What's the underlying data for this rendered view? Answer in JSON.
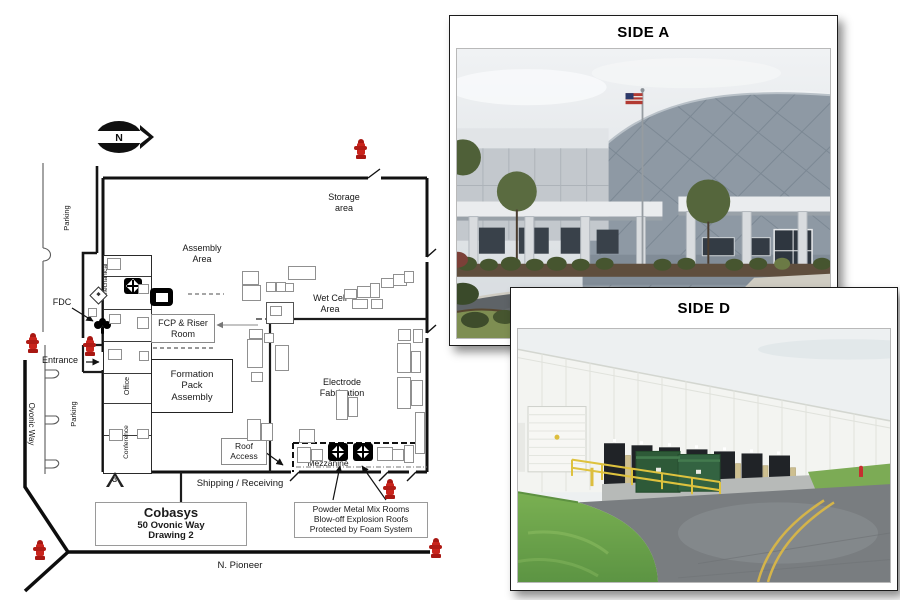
{
  "plan": {
    "north_label": "N",
    "streets": {
      "ovonic_way": "Ovonic Way",
      "n_pioneer": "N. Pioneer"
    },
    "parking": {
      "upper": "Parking",
      "lower": "Parking"
    },
    "areas": {
      "storage": "Storage\narea",
      "assembly": "Assembly\nArea",
      "wet_cell": "Wet Cell\nArea",
      "electrode_fabrication": "Electrode\nFabrication",
      "formation_pack": "Formation\nPack\nAssembly",
      "mezzanine": "Mezzanine",
      "shipping_receiving": "Shipping / Receiving",
      "mechanical": "Mechanical",
      "office": "Office",
      "conference": "Conference"
    },
    "boxes": {
      "fcp_riser": "FCP & Riser\nRoom",
      "roof_access": "Roof\nAccess"
    },
    "callouts": {
      "fdc": "FDC",
      "entrance": "Entrance",
      "gas_shutoff": "G"
    },
    "title_box": {
      "company": "Cobasys",
      "address": "50 Ovonic Way",
      "drawing": "Drawing 2"
    },
    "note_box": {
      "text": "Powder Metal Mix Rooms\nBlow-off Explosion Roofs\nProtected by Foam System"
    },
    "symbol_colors": {
      "fire_hydrant": "#c9241c",
      "plan_line": "#111111"
    }
  },
  "photos": {
    "side_a": {
      "title": "SIDE A"
    },
    "side_d": {
      "title": "SIDE D"
    }
  }
}
